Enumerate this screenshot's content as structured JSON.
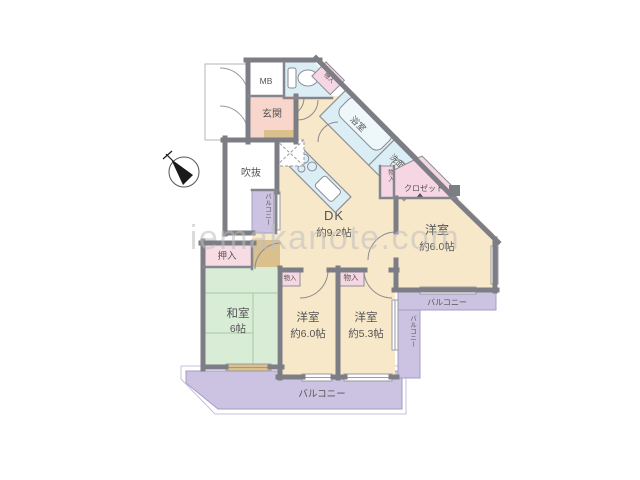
{
  "watermark": "iemakanote.com",
  "palette": {
    "room_cream": "#f7e8c9",
    "room_green": "#d8ecd6",
    "room_pink": "#f6d6e2",
    "room_salmon": "#f8d6cc",
    "fixture_blue": "#dceef5",
    "balcony_purple": "#cbc3e1",
    "wall_gray": "#7d7d85",
    "threshold_tan": "#d9c08d"
  },
  "rooms": {
    "meter_box": {
      "label": "MB"
    },
    "entrance": {
      "label": "玄関"
    },
    "void_space": {
      "label": "吹抜"
    },
    "corridor": {
      "label": "廊下"
    },
    "dining_kitchen": {
      "label": "DK",
      "size": "約9.2帖"
    },
    "bath": {
      "label": "浴室"
    },
    "washroom": {
      "label": "洗面室"
    },
    "closet": {
      "label": "クロゼット"
    },
    "storage_hall": {
      "label": "物入"
    },
    "storage_ne": {
      "label": "物入"
    },
    "storage_south_center": {
      "label": "物入"
    },
    "storage_south_east": {
      "label": "物入"
    },
    "bedroom_ne": {
      "label": "洋室",
      "size": "約6.0帖"
    },
    "bedroom_south_center": {
      "label": "洋室",
      "size": "約6.0帖"
    },
    "bedroom_south_east": {
      "label": "洋室",
      "size": "約5.3帖"
    },
    "japanese_room": {
      "label": "和室",
      "size": "6帖"
    },
    "oshiire": {
      "label": "押入"
    },
    "balcony_west": {
      "label": "バルコニー"
    },
    "balcony_east_upper": {
      "label": "バルコニー"
    },
    "balcony_east_side": {
      "label": "バルコニー"
    },
    "balcony_south": {
      "label": "バルコニー"
    }
  }
}
